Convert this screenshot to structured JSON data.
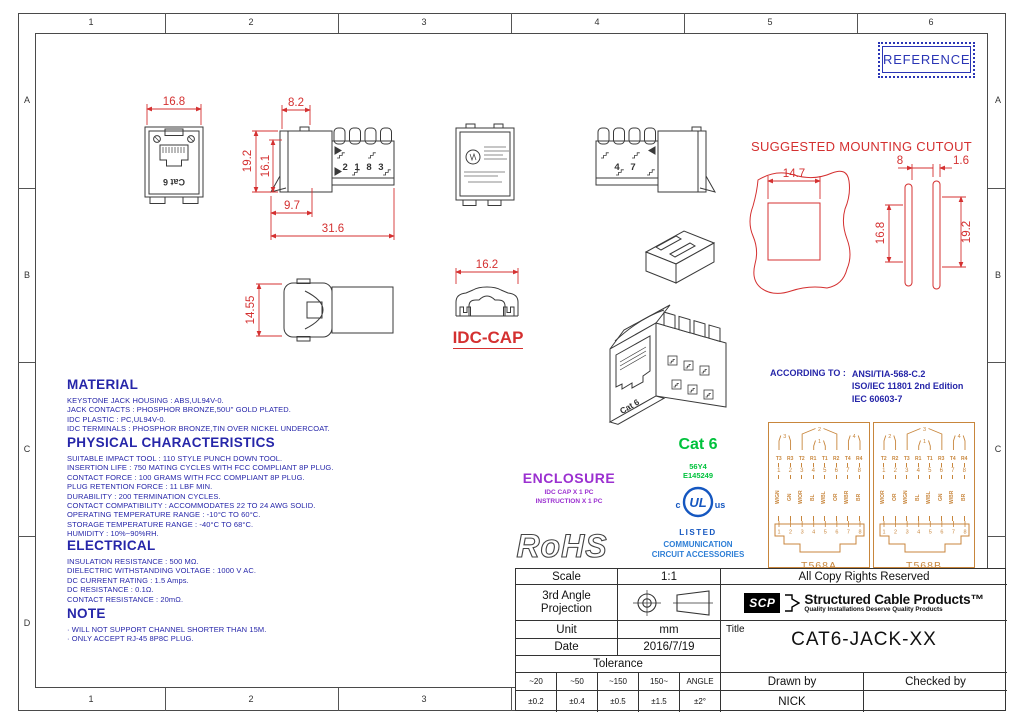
{
  "frame": {
    "columns": [
      "1",
      "2",
      "3",
      "4",
      "5",
      "6"
    ],
    "rows": [
      "A",
      "B",
      "C",
      "D"
    ]
  },
  "stamp": {
    "text": "REFERENCE"
  },
  "drawing": {
    "cutout_title": "SUGGESTED MOUNTING CUTOUT",
    "idc_cap_label": "IDC-CAP",
    "jack_marking": "Cat 6",
    "side_marking": "2 1 8 3",
    "right_marking": "4 7",
    "dims": {
      "front_width": "16.8",
      "side_top": "8.2",
      "side_height": "19.2",
      "side_inner_height": "16.1",
      "side_bottom": "9.7",
      "side_total": "31.6",
      "bottom_height": "14.55",
      "cap_width": "16.2",
      "cutout_width": "14.7",
      "cutout_gap": "8",
      "cutout_plate": "1.6",
      "cutout_height_a": "16.8",
      "cutout_height_b": "19.2"
    }
  },
  "sections": {
    "material": {
      "title": "MATERIAL",
      "lines": [
        "KEYSTONE JACK HOUSING : ABS,UL94V-0.",
        "JACK CONTACTS : PHOSPHOR BRONZE,50U\" GOLD PLATED.",
        "IDC PLASTIC : PC,UL94V-0.",
        "IDC TERMINALS : PHOSPHOR BRONZE,TIN OVER NICKEL UNDERCOAT."
      ]
    },
    "physical": {
      "title": "PHYSICAL CHARACTERISTICS",
      "lines": [
        "SUITABLE IMPACT TOOL : 110 STYLE PUNCH DOWN TOOL.",
        "INSERTION LIFE : 750 MATING CYCLES WITH FCC COMPLIANT 8P PLUG.",
        "CONTACT FORCE : 100 GRAMS WITH FCC COMPLIANT 8P PLUG.",
        "PLUG RETENTION FORCE : 11 LBF MIN.",
        "DURABILITY : 200 TERMINATION CYCLES.",
        "CONTACT COMPATIBILITY : ACCOMMODATES 22 TO 24 AWG SOLID.",
        "OPERATING TEMPERATURE RANGE : -10°C TO 60°C.",
        "STORAGE TEMPERATURE RANGE : -40°C TO 68°C.",
        "HUMIDITY : 10%~90%RH."
      ]
    },
    "electrical": {
      "title": "ELECTRICAL",
      "lines": [
        "INSULATION RESISTANCE : 500 MΩ.",
        "DIELECTRIC WITHSTANDING VOLTAGE : 1000 V AC.",
        "DC CURRENT RATING : 1.5 Amps.",
        "DC RESISTANCE : 0.1Ω.",
        "CONTACT RESISTANCE : 20mΩ."
      ]
    },
    "note": {
      "title": "NOTE",
      "lines": [
        "·  WILL NOT SUPPORT CHANNEL SHORTER THAN 15M.",
        "·  ONLY ACCEPT RJ-45 8P8C PLUG."
      ]
    }
  },
  "enclosure": {
    "title": "ENCLOSURE",
    "lines": [
      "IDC CAP X 1 PC",
      "INSTRUCTION X 1 PC"
    ]
  },
  "rohs": "RoHS",
  "certification": {
    "category": "Cat 6",
    "file_codes": [
      "56Y4",
      "E145249"
    ],
    "ul_mark": {
      "c": "c",
      "letters": "UL",
      "us": "us",
      "listed": "LISTED"
    },
    "listing_lines": [
      "COMMUNICATION",
      "CIRCUIT ACCESSORIES"
    ]
  },
  "according": {
    "label": "ACCORDING TO :",
    "standards": [
      "ANSI/TIA-568-C.2",
      "ISO/IEC 11801 2nd Edition",
      "IEC 60603-7"
    ]
  },
  "wiring": {
    "numbers": [
      "1",
      "2",
      "3",
      "4",
      "5",
      "6",
      "7",
      "8"
    ],
    "t568a": {
      "name": "T568A",
      "pins": [
        "T3",
        "R3",
        "T2",
        "R1",
        "T1",
        "R2",
        "T4",
        "R4"
      ],
      "colors": [
        "W/GN",
        "GN",
        "W/OR",
        "BL",
        "W/BL",
        "OR",
        "W/BR",
        "BR"
      ],
      "pairs": [
        {
          "label": "3",
          "from": 1,
          "to": 2
        },
        {
          "label": "2",
          "from": 3,
          "to": 6
        },
        {
          "label": "1",
          "from": 4,
          "to": 5
        },
        {
          "label": "4",
          "from": 7,
          "to": 8
        }
      ]
    },
    "t568b": {
      "name": "T568B",
      "pins": [
        "T2",
        "R2",
        "T3",
        "R1",
        "T1",
        "R3",
        "T4",
        "R4"
      ],
      "colors": [
        "W/OR",
        "OR",
        "W/GN",
        "BL",
        "W/BL",
        "GN",
        "W/BR",
        "BR"
      ],
      "pairs": [
        {
          "label": "2",
          "from": 1,
          "to": 2
        },
        {
          "label": "3",
          "from": 3,
          "to": 6
        },
        {
          "label": "1",
          "from": 4,
          "to": 5
        },
        {
          "label": "4",
          "from": 7,
          "to": 8
        }
      ]
    }
  },
  "titleblock": {
    "scale_label": "Scale",
    "scale_value": "1:1",
    "projection_label": "3rd Angle Projection",
    "unit_label": "Unit",
    "unit_value": "mm",
    "date_label": "Date",
    "date_value": "2016/7/19",
    "tolerance_label": "Tolerance",
    "tolerance_headers": [
      "~20",
      "~50",
      "~150",
      "150~",
      "ANGLE"
    ],
    "tolerance_values": [
      "±0.2",
      "±0.4",
      "±0.5",
      "±1.5",
      "±2°"
    ],
    "copyright": "All Copy Rights Reserved",
    "brand": {
      "abbr": "SCP",
      "name": "Structured Cable Products™",
      "tagline": "Quality Installations Deserve Quality Products"
    },
    "title_label": "Title",
    "title_value": "CAT6-JACK-XX",
    "drawn_label": "Drawn by",
    "drawn_value": "NICK",
    "checked_label": "Checked by",
    "checked_value": ""
  }
}
